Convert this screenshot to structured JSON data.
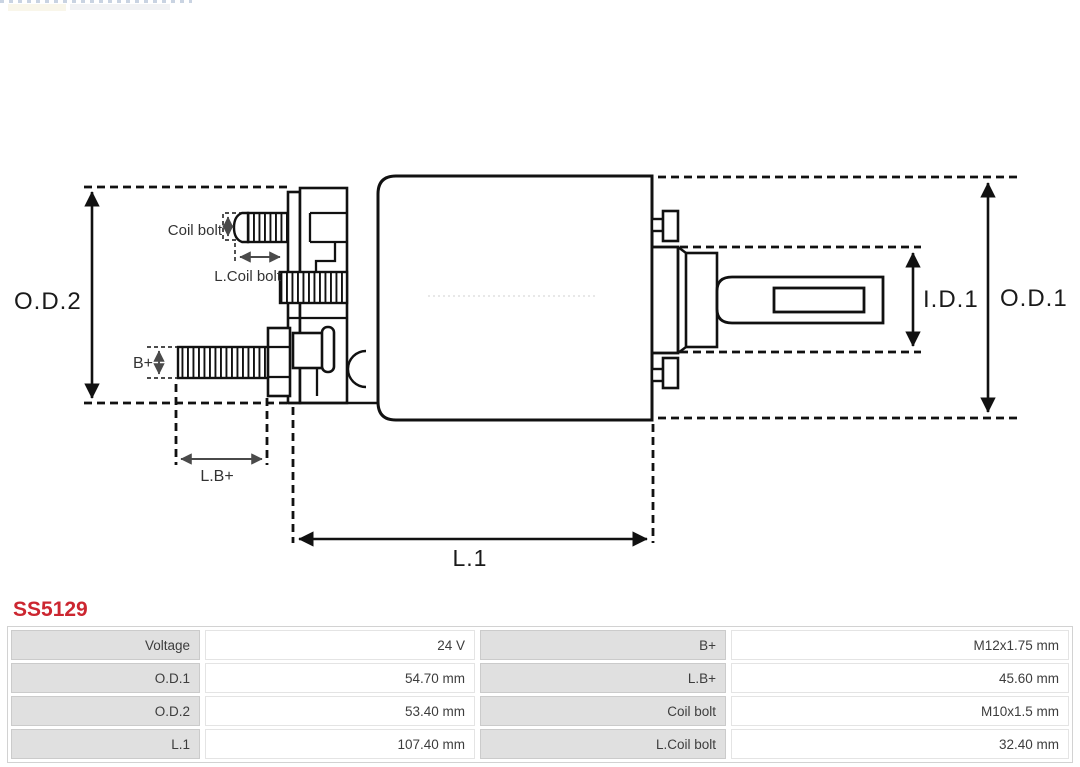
{
  "product": {
    "code": "SS5129"
  },
  "diagram": {
    "labels": {
      "od2": "O.D.2",
      "od1": "O.D.1",
      "id1": "I.D.1",
      "l1": "L.1",
      "lbplus": "L.B+",
      "bplus": "B+",
      "coil_bolt": "Coil bolt",
      "l_coil_bolt": "L.Coil bolt"
    }
  },
  "spec_table": {
    "rows": [
      {
        "c1_label": "Voltage",
        "c1_value": "24 V",
        "c2_label": "B+",
        "c2_value": "M12x1.75 mm"
      },
      {
        "c1_label": "O.D.1",
        "c1_value": "54.70 mm",
        "c2_label": "L.B+",
        "c2_value": "45.60 mm"
      },
      {
        "c1_label": "O.D.2",
        "c1_value": "53.40 mm",
        "c2_label": "Coil bolt",
        "c2_value": "M10x1.5 mm"
      },
      {
        "c1_label": "L.1",
        "c1_value": "107.40 mm",
        "c2_label": "L.Coil bolt",
        "c2_value": "32.40 mm"
      }
    ]
  },
  "colors": {
    "accent_red": "#cc2630",
    "table_label_bg": "#e0e0e0",
    "line": "#111111"
  }
}
